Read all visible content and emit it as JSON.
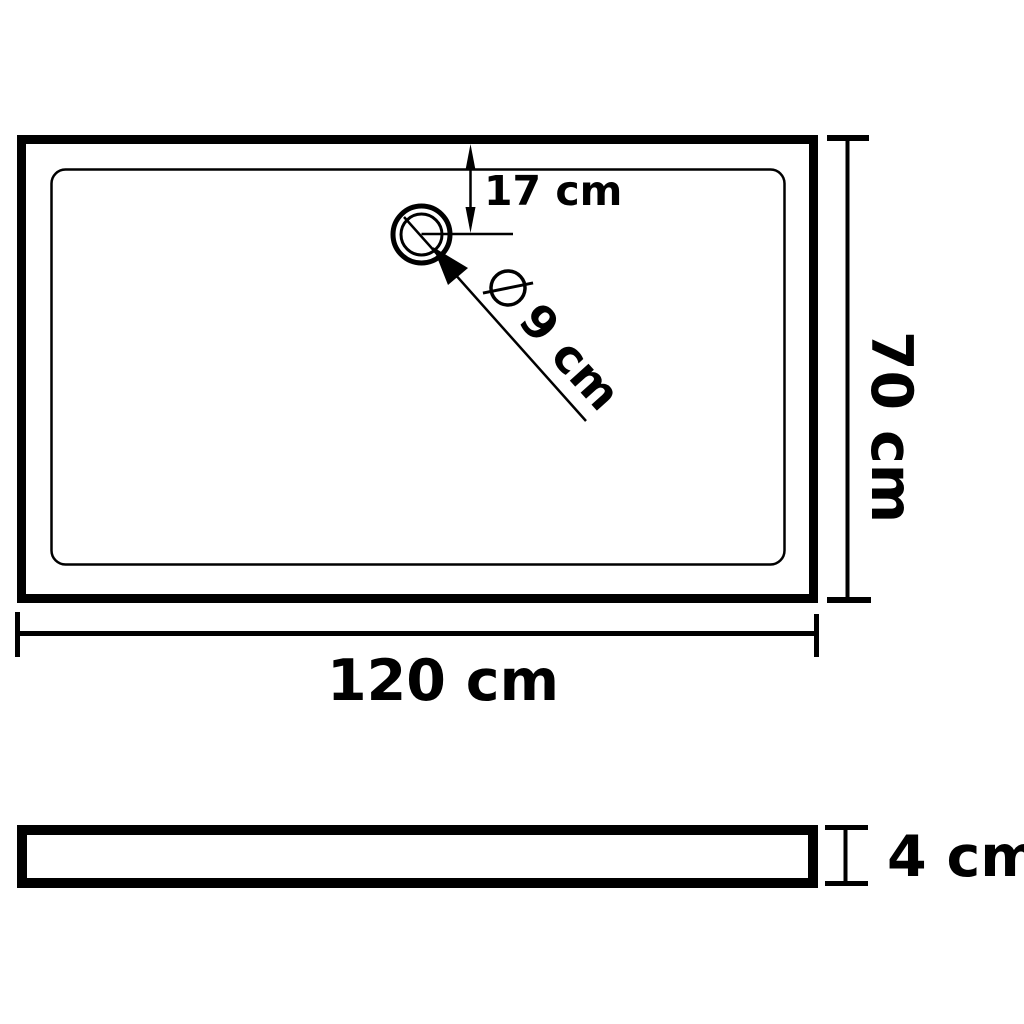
{
  "diagram": {
    "type": "technical-drawing",
    "subject": "rectangular shower base tray with drain, top view and side profile view",
    "colors": {
      "stroke": "#000000",
      "background": "#ffffff"
    },
    "top_view": {
      "length_label": "120 cm",
      "width_label": "70 cm",
      "drain_offset_label": "17 cm",
      "drain_diameter_value_label": "9 cm",
      "drain_diameter_symbol_icon": "diameter-sign"
    },
    "side_view": {
      "thickness_label": "4 cm"
    }
  }
}
